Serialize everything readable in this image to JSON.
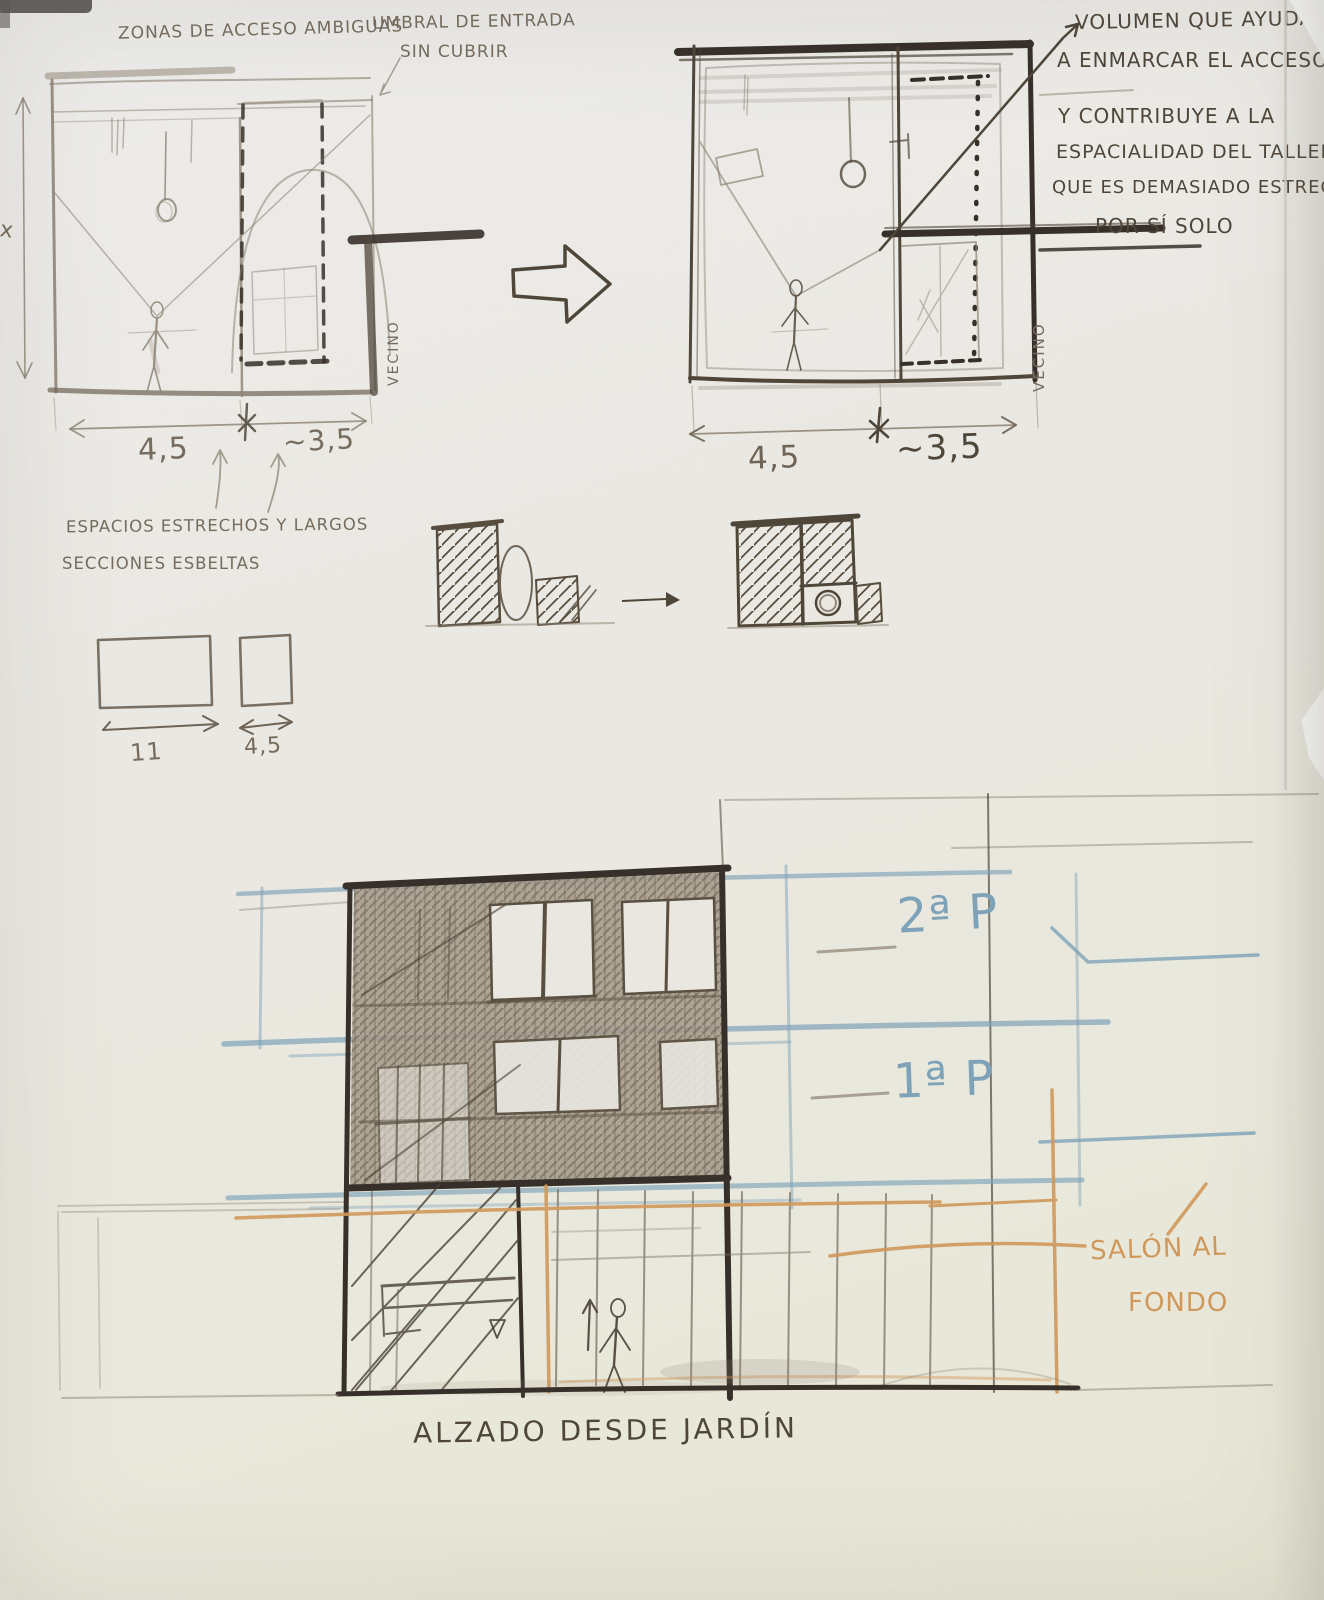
{
  "colors": {
    "paper": "#eae8e0",
    "pencil": "#8b8172",
    "pencil_dark": "#6e6456",
    "pen": "#4f463a",
    "pen_dark": "#37302a",
    "blue": "#7ea3b8",
    "orange": "#d0985a",
    "shade_fill": "#a59a8a"
  },
  "top_left_plan": {
    "note_access": "ZONAS DE ACCESO AMBIGUAS",
    "note_threshold_line1": "UMBRAL DE ENTRADA",
    "note_threshold_line2": "SIN CUBRIR",
    "dim_left": "4,5",
    "dim_right": "~3,5",
    "dim_height": "x",
    "neighbor": "VECINO"
  },
  "top_right_plan": {
    "dim_left": "4,5",
    "dim_right": "~3,5",
    "neighbor": "VECINO",
    "annotation_lines": [
      "VOLUMEN QUE AYUDA",
      "A ENMARCAR EL ACCESO",
      "Y CONTRIBUYE A LA",
      "ESPACIALIDAD DEL TALLER,",
      "QUE ES DEMASIADO ESTRECHO",
      "POR SÍ SOLO"
    ]
  },
  "middle_notes": {
    "line1": "ESPACIOS ESTRECHOS Y LARGOS",
    "line2": "SECCIONES ESBELTAS",
    "bar_long_dim": "11",
    "bar_short_dim": "4,5"
  },
  "elevation": {
    "floor_2_label": "2ª P",
    "floor_1_label": "1ª P",
    "salon_line1": "SALÓN AL",
    "salon_line2": "FONDO",
    "title": "ALZADO DESDE JARDÍN"
  }
}
